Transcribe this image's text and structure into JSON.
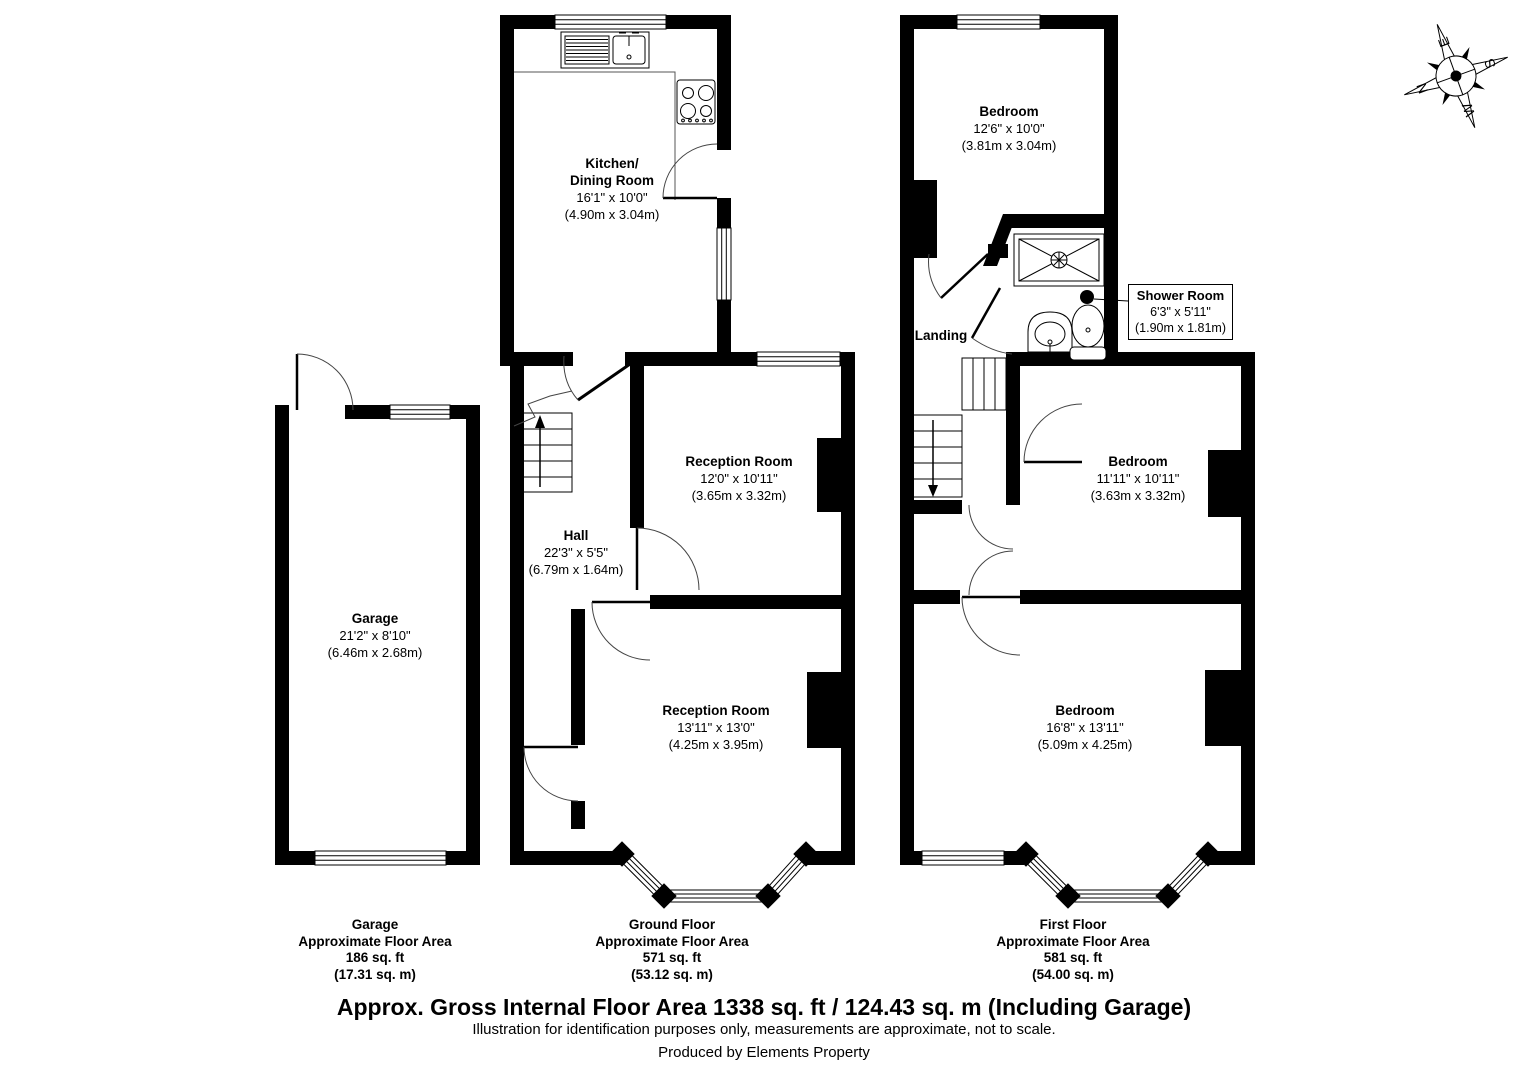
{
  "rooms": {
    "kitchen": {
      "name1": "Kitchen/",
      "name2": "Dining Room",
      "dims": "16'1\" x 10'0\"",
      "metric": "(4.90m x 3.04m)"
    },
    "reception1": {
      "name": "Reception Room",
      "dims": "12'0\" x 10'11\"",
      "metric": "(3.65m x 3.32m)"
    },
    "hall": {
      "name": "Hall",
      "dims": "22'3\" x 5'5\"",
      "metric": "(6.79m x 1.64m)"
    },
    "reception2": {
      "name": "Reception Room",
      "dims": "13'11\" x 13'0\"",
      "metric": "(4.25m x 3.95m)"
    },
    "garage": {
      "name": "Garage",
      "dims": "21'2\" x 8'10\"",
      "metric": "(6.46m x 2.68m)"
    },
    "bedroom_top": {
      "name": "Bedroom",
      "dims": "12'6\" x 10'0\"",
      "metric": "(3.81m x 3.04m)"
    },
    "landing": {
      "name": "Landing"
    },
    "shower": {
      "name": "Shower Room",
      "dims": "6'3\" x 5'11\"",
      "metric": "(1.90m x 1.81m)"
    },
    "bedroom_mid": {
      "name": "Bedroom",
      "dims": "11'11\" x 10'11\"",
      "metric": "(3.63m x 3.32m)"
    },
    "bedroom_bottom": {
      "name": "Bedroom",
      "dims": "16'8\" x 13'11\"",
      "metric": "(5.09m x 4.25m)"
    }
  },
  "areas": {
    "garage": {
      "title": "Garage",
      "subtitle": "Approximate Floor Area",
      "imperial": "186 sq. ft",
      "metric": "(17.31 sq. m)"
    },
    "ground": {
      "title": "Ground Floor",
      "subtitle": "Approximate Floor Area",
      "imperial": "571 sq. ft",
      "metric": "(53.12 sq. m)"
    },
    "first": {
      "title": "First Floor",
      "subtitle": "Approximate Floor Area",
      "imperial": "581 sq. ft",
      "metric": "(54.00 sq. m)"
    }
  },
  "summary": {
    "title": "Approx. Gross Internal Floor Area 1338 sq. ft / 124.43 sq. m (Including Garage)",
    "disclaimer": "Illustration for identification purposes only, measurements are approximate, not to scale.",
    "credit": "Produced by Elements Property"
  },
  "compass": {
    "north": "N",
    "east": "E",
    "south": "S",
    "west": "W"
  },
  "colors": {
    "wall": "#000000",
    "background": "#ffffff",
    "thin_line": "#404040"
  }
}
